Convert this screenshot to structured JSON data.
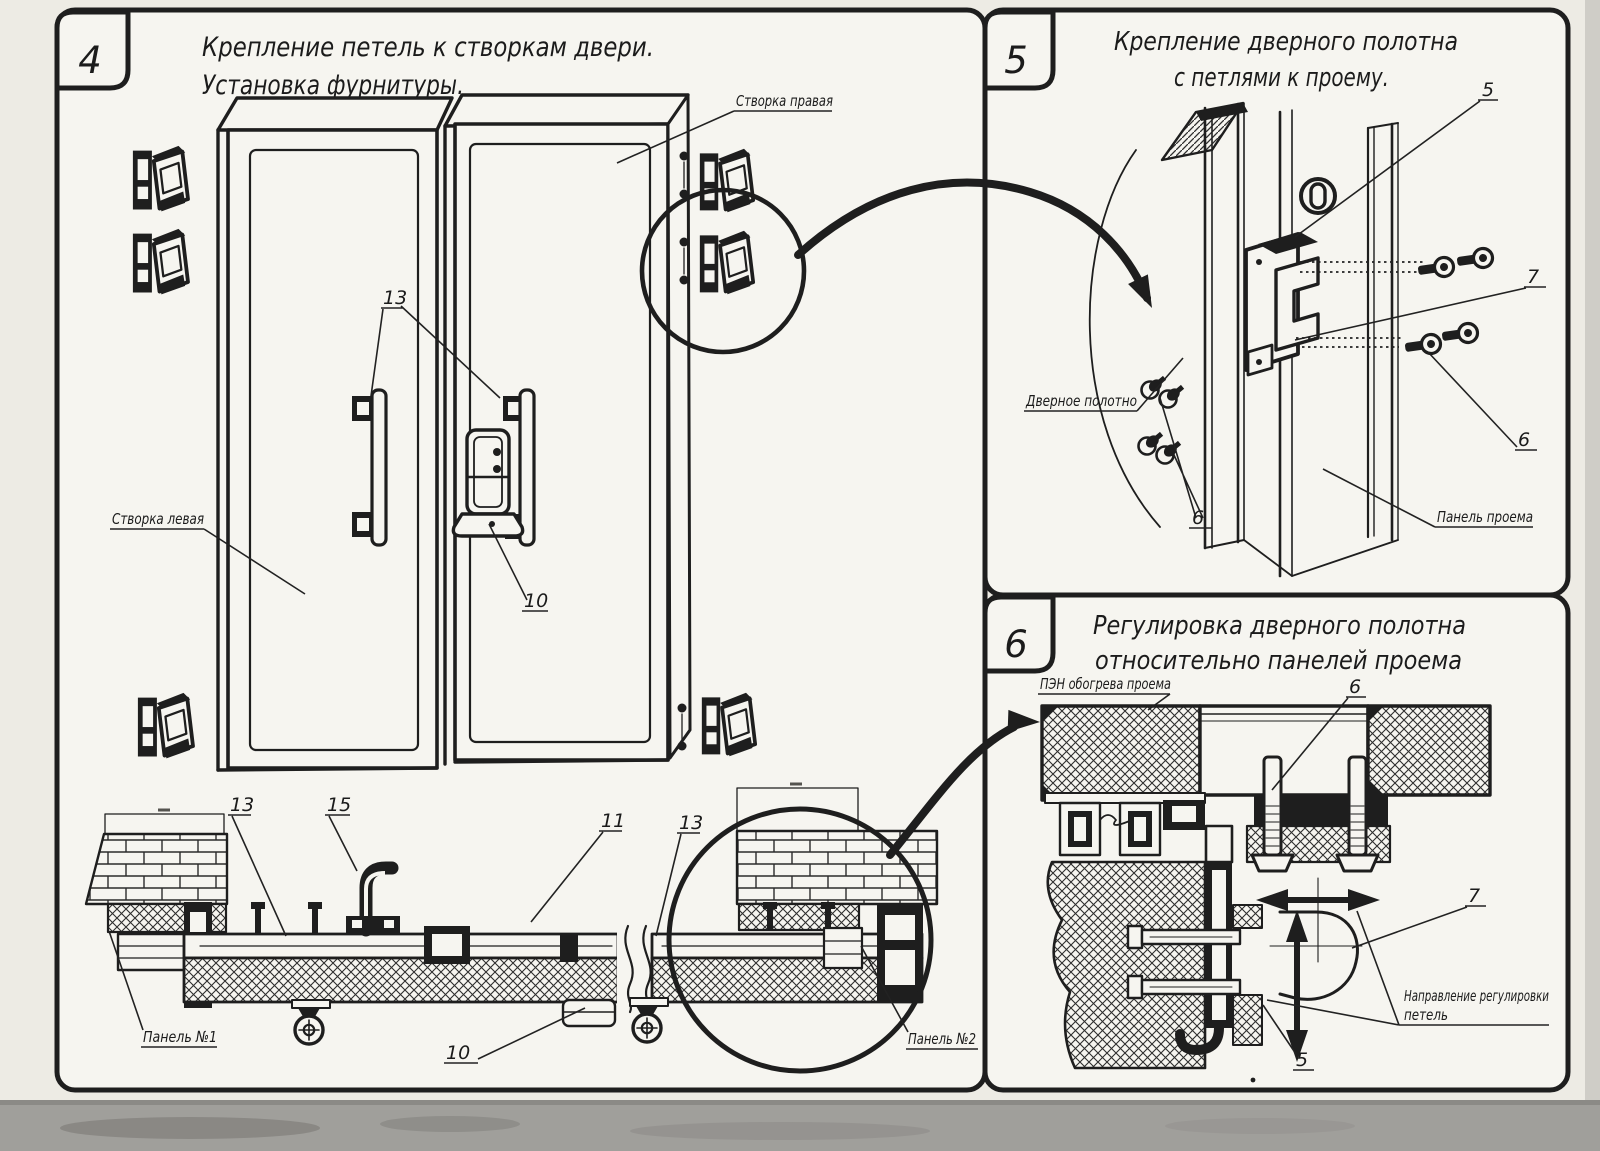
{
  "colors": {
    "ink": "#1e1e1e",
    "paper": "#f3f2ec",
    "panel_fill": "#f6f5f0",
    "page_edge": "#c7c5bf",
    "scan_strip": "#a09f9b"
  },
  "panel4": {
    "number": "4",
    "title_line1": "Крепление петель к створкам двери.",
    "title_line2": "Установка фурнитуры.",
    "label_leaf_right": "Створка правая",
    "label_leaf_left": "Створка левая",
    "label_panel1": "Панель №1",
    "label_panel2": "Панель №2",
    "num_handle": "13",
    "num_latch": "10",
    "num_hinge_handle": "15",
    "num_profile": "11"
  },
  "panel5": {
    "number": "5",
    "title_line1": "Крепление дверного полотна",
    "title_line2": "с петлями к проему.",
    "label_door_leaf": "Дверное полотно",
    "label_opening_panel": "Панель проема",
    "num_hinge": "5",
    "num_screw": "6",
    "num_plate": "7"
  },
  "panel6": {
    "number": "6",
    "title_line1": "Регулировка дверного полотна",
    "title_line2": "относительно панелей проема",
    "label_heater": "ПЭН обогрева проема",
    "label_direction_1": "Направление регулировки",
    "label_direction_2": "петель",
    "num_bolt": "6",
    "num_hinge_plate": "7",
    "num_profile": "5"
  }
}
